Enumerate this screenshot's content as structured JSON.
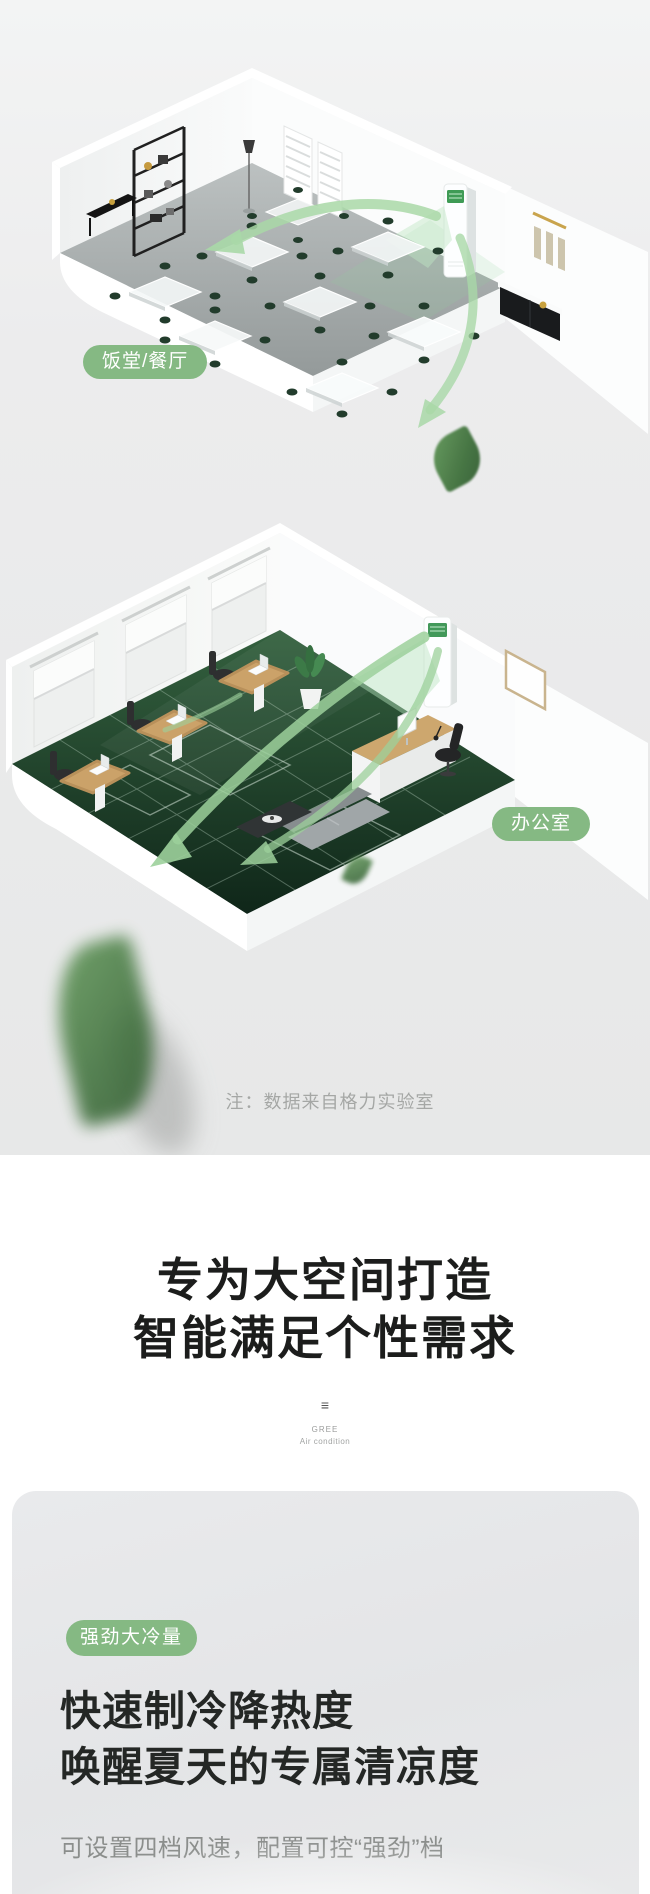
{
  "scenes": {
    "dining": {
      "label": "饭堂/餐厅"
    },
    "office": {
      "label": "办公室"
    },
    "note": "注：数据来自格力实验室"
  },
  "headline": {
    "line1": "专为大空间打造",
    "line2": "智能满足个性需求"
  },
  "brand": {
    "mark": "≡",
    "name": "GREE",
    "tagline": "Air condition"
  },
  "feature": {
    "badge": "强劲大冷量",
    "title_line1": "快速制冷降热度",
    "title_line2": "唤醒夏天的专属清凉度",
    "desc": "可设置四档风速，配置可控“强劲”档"
  },
  "colors": {
    "badge_green": "#85b983",
    "arrow_green": "#a3d5a1",
    "heading_dark": "#1c1d1c",
    "note_gray": "#a5a7a5",
    "desc_gray": "#8b8e8c",
    "carpet_green": "#234c31",
    "ac_screen_green": "#42985a"
  }
}
